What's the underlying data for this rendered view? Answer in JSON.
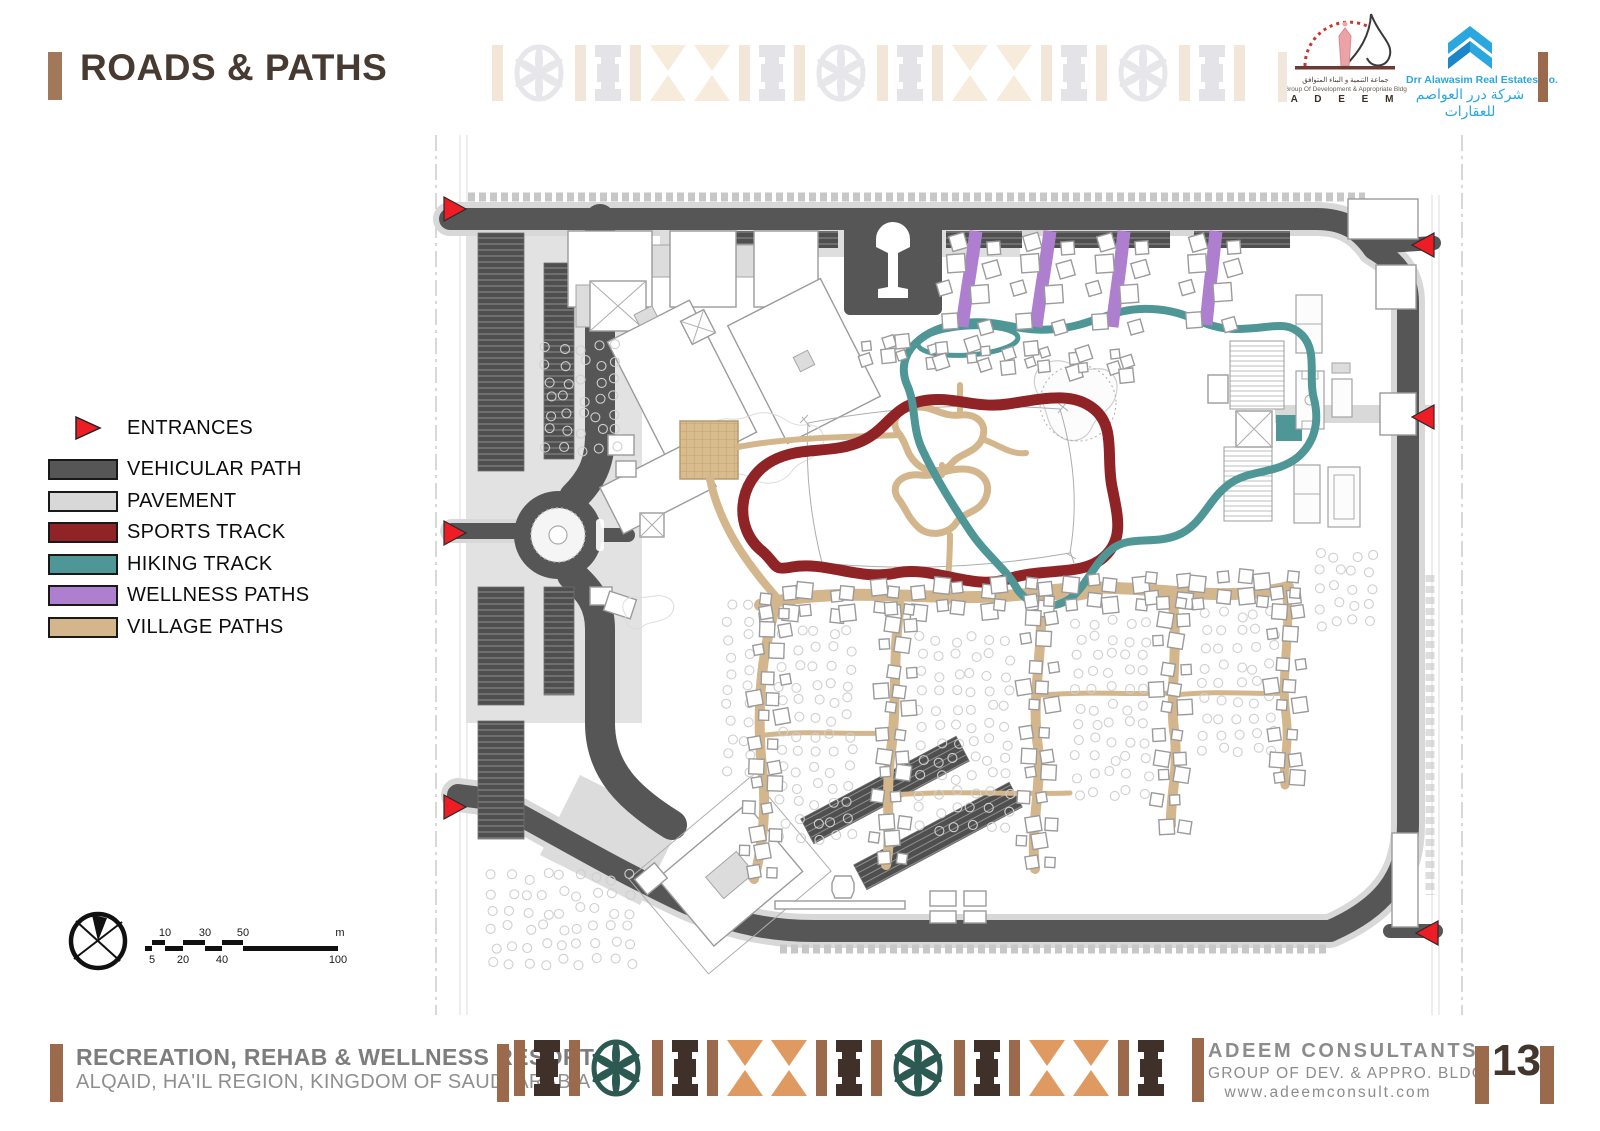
{
  "header": {
    "title": "ROADS & PATHS",
    "accent_color": "#a1785a"
  },
  "logos": {
    "adeem": {
      "arabic": "جماعة التنمية و البناء المتوافق",
      "tagline": "Group Of Development & Appropriate Bldg",
      "wordmark": "A D E E M"
    },
    "alawasim": {
      "name": "Drr Alawasim Real Estates Co.",
      "arabic": "شركة درر العواصم للعقارات",
      "brand_color": "#2ba7e0"
    }
  },
  "legend": {
    "items": [
      {
        "label": "ENTRANCES",
        "swatch": "triangle",
        "color": "#ee1c25"
      },
      {
        "label": "VEHICULAR PATH",
        "swatch": "rect",
        "color": "#565656"
      },
      {
        "label": "PAVEMENT",
        "swatch": "rect",
        "color": "#d8d8d8"
      },
      {
        "label": "SPORTS TRACK",
        "swatch": "rect",
        "color": "#8f2326"
      },
      {
        "label": "HIKING TRACK",
        "swatch": "rect",
        "color": "#4f9697"
      },
      {
        "label": "WELLNESS PATHS",
        "swatch": "rect",
        "color": "#ad7fce"
      },
      {
        "label": "VILLAGE PATHS",
        "swatch": "rect",
        "color": "#d3b68c"
      }
    ]
  },
  "scale_bar": {
    "unit": "m",
    "top_labels": [
      "10",
      "30",
      "50"
    ],
    "bottom_labels": [
      "5",
      "20",
      "40",
      "100"
    ]
  },
  "footer": {
    "project_title": "RECREATION, REHAB & WELLNESS RESORT",
    "project_location": "ALQAID, HA'IL REGION, KINGDOM OF SAUDI ARABIA",
    "company": "ADEEM CONSULTANTS",
    "company_subtitle": "GROUP OF DEV. & APPRO. BLDG",
    "website": "www.adeemconsult.com",
    "page_number": "13"
  },
  "theme": {
    "accent_brown": "#9b6a4c",
    "dark_brown": "#40302a",
    "pattern_teal": "#2c5a53",
    "pattern_orange": "#df9a61",
    "title_color": "#473a31",
    "text_gray": "#8c8c8c"
  }
}
